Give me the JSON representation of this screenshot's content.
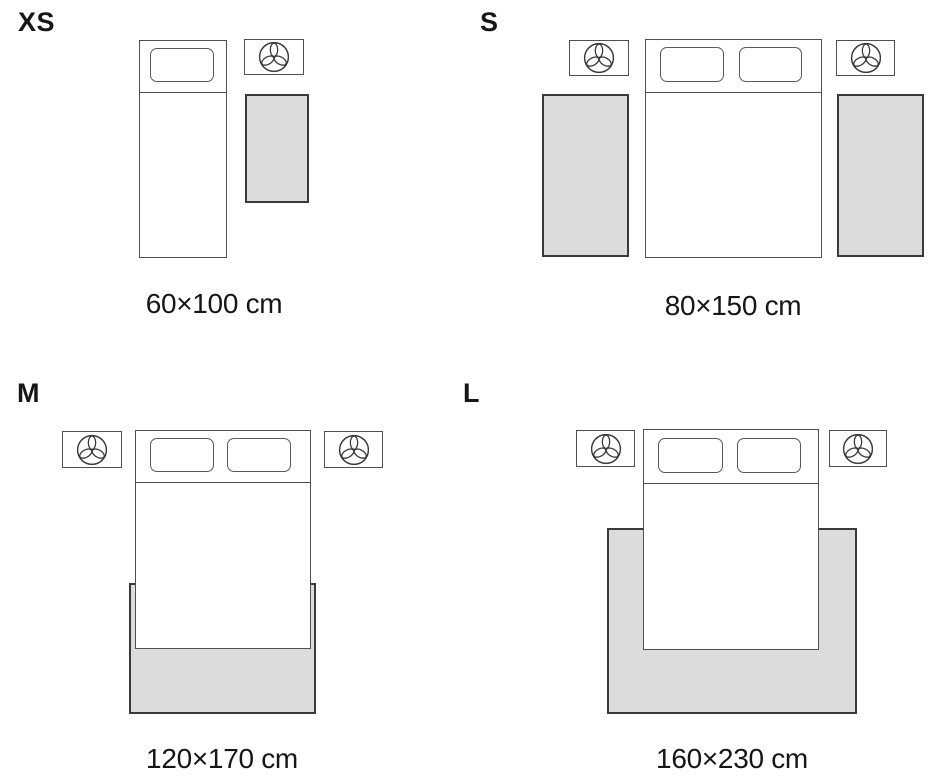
{
  "title": "Rug size guide by bed placement",
  "colors": {
    "background": "#ffffff",
    "text": "#161616",
    "furniture_border": "#4f4f4f",
    "rug_border": "#3a3a3a",
    "rug_fill": "#dcdcdc"
  },
  "nightstand_icon": "plant-top-view-icon",
  "sections": [
    {
      "id": "xs",
      "size_label": "XS",
      "caption": "60×100 cm",
      "bed_type": "single",
      "pillow_count": 1,
      "nightstand_count": 1,
      "rug_count": 1,
      "rug_placement": "beside bed"
    },
    {
      "id": "s",
      "size_label": "S",
      "caption": "80×150 cm",
      "bed_type": "double",
      "pillow_count": 2,
      "nightstand_count": 2,
      "rug_count": 2,
      "rug_placement": "runner on each side of bed"
    },
    {
      "id": "m",
      "size_label": "M",
      "caption": "120×170 cm",
      "bed_type": "double",
      "pillow_count": 2,
      "nightstand_count": 2,
      "rug_count": 1,
      "rug_placement": "under foot of bed"
    },
    {
      "id": "l",
      "size_label": "L",
      "caption": "160×230 cm",
      "bed_type": "double",
      "pillow_count": 2,
      "nightstand_count": 2,
      "rug_count": 1,
      "rug_placement": "large, under lower two-thirds of bed"
    }
  ]
}
